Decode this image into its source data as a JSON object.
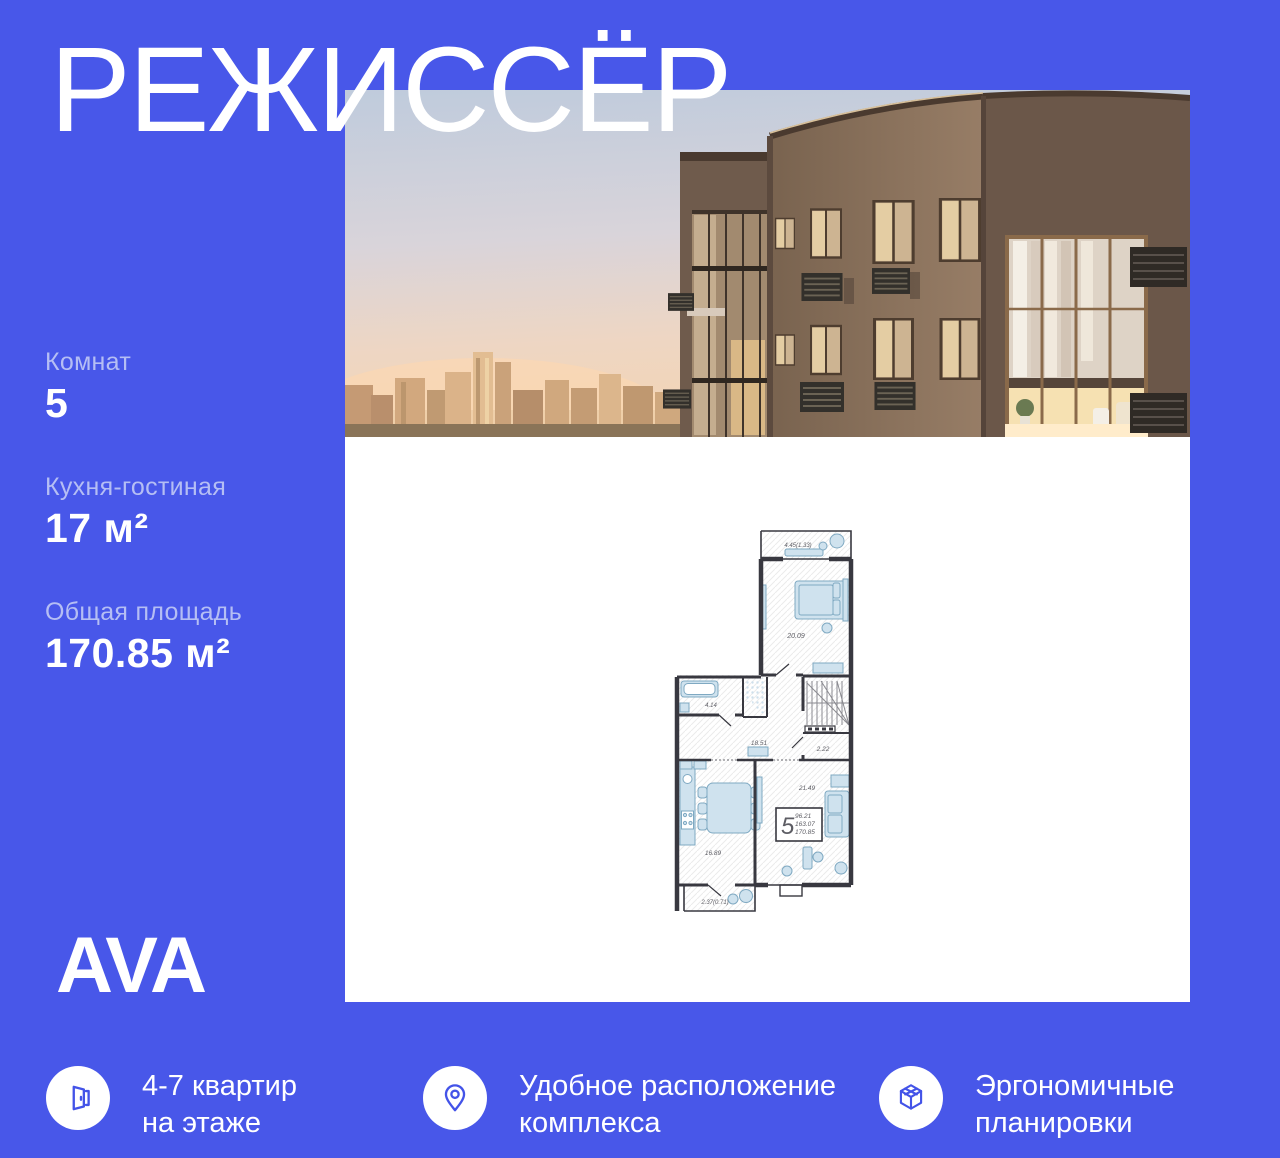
{
  "page": {
    "accent_blue": "#4857E9",
    "panel_white": "#ffffff",
    "label_blue": "#b5bef4"
  },
  "title": "РЕЖИССЁР",
  "stats": [
    {
      "label": "Комнат",
      "value": "5"
    },
    {
      "label": "Кухня-гостиная",
      "value": "17 м²"
    },
    {
      "label": "Общая площадь",
      "value": "170.85 м²"
    }
  ],
  "logo": "AVA",
  "features": [
    {
      "icon": "door-icon",
      "lines": [
        "4-7 квартир",
        "на этаже"
      ]
    },
    {
      "icon": "pin-icon",
      "lines": [
        "Удобное расположение",
        "комплекса"
      ]
    },
    {
      "icon": "cube-icon",
      "lines": [
        "Эргономичные",
        "планировки"
      ]
    }
  ],
  "floor_plan": {
    "apartment_number": "5",
    "areas": [
      "96.21",
      "163.07",
      "170.85"
    ],
    "rooms": [
      {
        "name": "balcony-top",
        "area_label": "4.45(1.33)"
      },
      {
        "name": "bedroom",
        "area_label": "20.09"
      },
      {
        "name": "bathroom",
        "area_label": "4.14"
      },
      {
        "name": "hall",
        "area_label": "18.51"
      },
      {
        "name": "storage",
        "area_label": "2.22"
      },
      {
        "name": "living-room",
        "area_label": "21.49"
      },
      {
        "name": "kitchen",
        "area_label": "16.89"
      },
      {
        "name": "balcony-bottom",
        "area_label": "2.37(0.71)"
      }
    ]
  }
}
